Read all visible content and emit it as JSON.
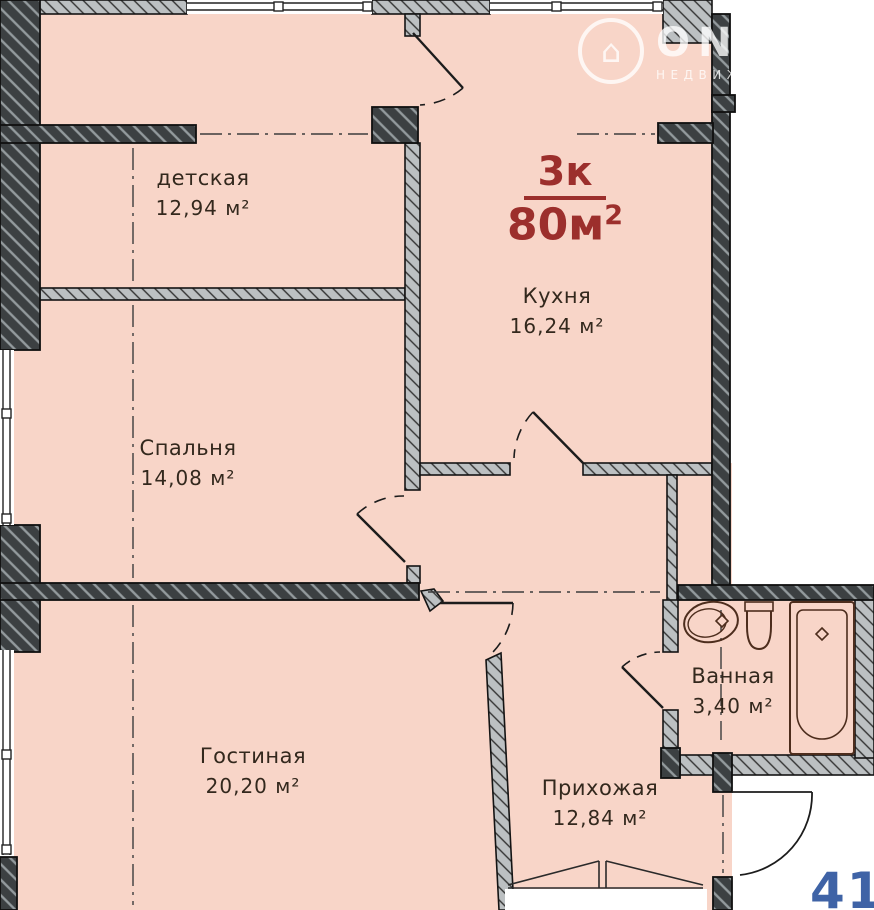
{
  "watermark": {
    "brand": "ONREALT",
    "subtitle": "НЕДВИЖИМОСТЬ"
  },
  "title": {
    "numerator": "3к",
    "denominator": "80м",
    "superscript": "2"
  },
  "rooms": {
    "detskaya": {
      "name": "детская",
      "area": "12,94 м²"
    },
    "kitchen": {
      "name": "Кухня",
      "area": "16,24 м²"
    },
    "bedroom": {
      "name": "Спальня",
      "area": "14,08 м²"
    },
    "living": {
      "name": "Гостиная",
      "area": "20,20 м²"
    },
    "bathroom": {
      "name": "Ванная",
      "area": "3,40 м²"
    },
    "hallway": {
      "name": "Прихожая",
      "area": "12,84 м²"
    }
  },
  "corner_number": "410",
  "colors": {
    "floor_fill": "#f8d5c8",
    "wall_dark": "#3c4042",
    "wall_light": "#bcc0c2",
    "outline": "#141414",
    "fixture_line": "#4d2d1d",
    "title_red": "#9c2f2c",
    "number_blue": "#3f63a6",
    "label_text": "#33281d"
  }
}
